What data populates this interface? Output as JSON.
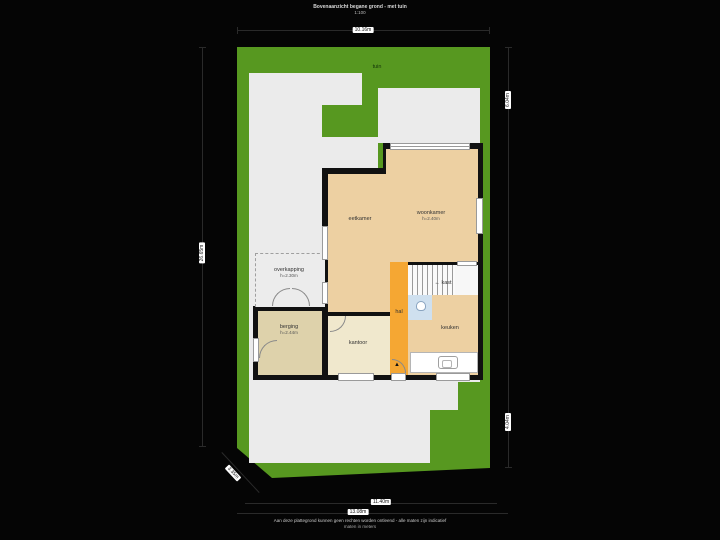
{
  "title": {
    "line1": "Bovenaanzicht begane grond - met tuin",
    "line2": "1:100"
  },
  "garden": {
    "label": "tuin"
  },
  "rooms": {
    "eetkamer": {
      "label": "eetkamer"
    },
    "woonkamer": {
      "label": "woonkamer",
      "height": "h=2.40m"
    },
    "overkapping": {
      "label": "overkapping",
      "height": "h=2.30m"
    },
    "berging": {
      "label": "berging",
      "height": "h=2.44m"
    },
    "kantoor": {
      "label": "kantoor"
    },
    "hal": {
      "label": "hal"
    },
    "kast": {
      "label": "kast",
      "arrow": "←"
    },
    "keuken": {
      "label": "keuken"
    }
  },
  "markers": {
    "entrance": "▲"
  },
  "dimensions": {
    "top": "10.16m",
    "left": "26.65m",
    "right_top": "6.04m",
    "right_bottom": "4.04m",
    "bottom_inner": "11.40m",
    "bottom_outer": "13.08m",
    "diagonal": "3.35m"
  },
  "footer": {
    "line1": "Aan deze plattegrond kunnen geen rechten worden ontleend - alle maten zijn indicatief",
    "line2": "maten in meters"
  },
  "colors": {
    "garden": "#579820",
    "terrace": "#ebebeb",
    "living": "#edd0a2",
    "office": "#f0e8cd",
    "storage": "#ded2ab",
    "hall": "#f5a733",
    "toilet": "#cfe0ef",
    "walls": "#111111"
  }
}
